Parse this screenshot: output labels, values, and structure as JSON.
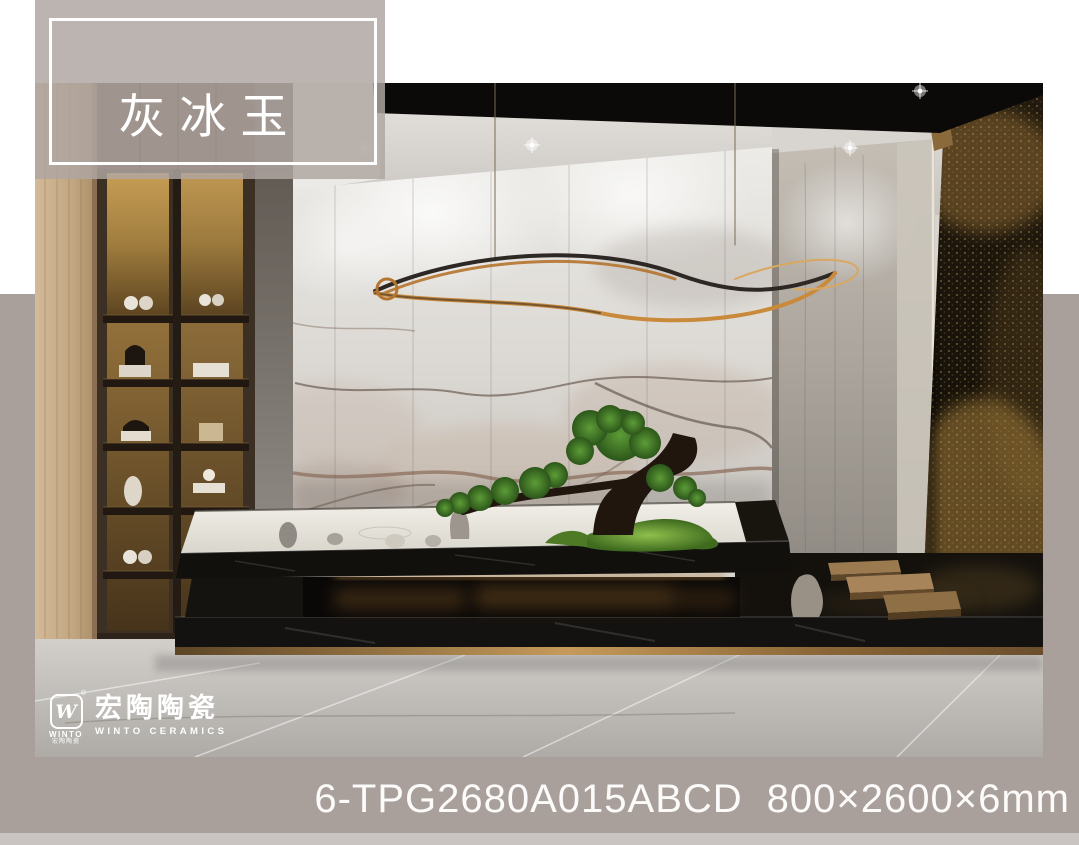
{
  "page": {
    "width": 1079,
    "height": 845,
    "background_top": "#ffffff",
    "background_main": "#a9a09c",
    "footer_strip": "#c9c4c1"
  },
  "product_label": {
    "title": "灰冰玉",
    "text_color": "#ffffff",
    "border_color": "#ffffff",
    "fill": "rgba(175,166,161,0.84)"
  },
  "brand": {
    "mark_letter": "W",
    "registered": "®",
    "mark_sub_en": "WINTO",
    "mark_sub_cn": "宏陶陶瓷",
    "name_cn": "宏陶陶瓷",
    "name_en": "WINTO CERAMICS",
    "color": "#ffffff"
  },
  "product": {
    "code": "6-TPG2680A015ABCD",
    "size": "800×2600×6mm",
    "text_color": "#fcfbfa"
  },
  "scene": {
    "accent_gold": "#c98a3c",
    "marble_base": "#dedbd6",
    "platform_black": "#121110",
    "bonsai_green": "#4f8f2e"
  }
}
